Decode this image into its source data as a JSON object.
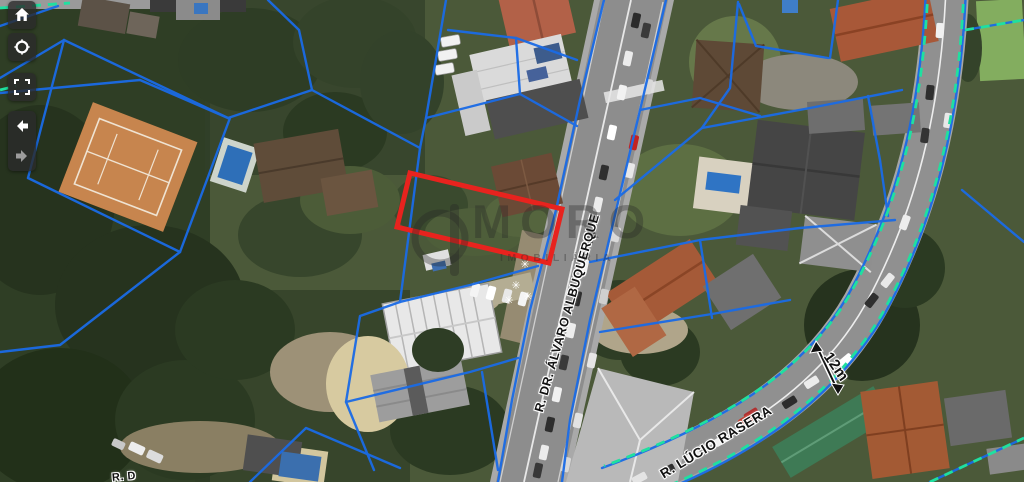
{
  "watermark": {
    "brand": "MORO",
    "tagline": "IMOBILIÁRIA"
  },
  "streets": [
    {
      "name": "R. DR. ÁLVARO ALBUQUERQUE"
    },
    {
      "name": "R. LÚCIO RASERA"
    }
  ],
  "annotations": {
    "road_width": "12m",
    "clipped_street_label": "R. D",
    "tree_symbol": "✳"
  },
  "toolbar": {
    "buttons": [
      {
        "id": "home",
        "icon": "home-icon"
      },
      {
        "id": "locate",
        "icon": "locate-icon"
      },
      {
        "id": "fullscreen",
        "icon": "fullscreen-icon"
      },
      {
        "id": "back",
        "icon": "back-arrow-icon"
      },
      {
        "id": "forward",
        "icon": "forward-arrow-icon"
      }
    ]
  },
  "colors": {
    "parcel_line": "#1a6be6",
    "road_guide_dash": "#1fe0a0",
    "selected_parcel": "#e8231e",
    "pool_water": "#3f7ec9",
    "tennis_court": "#c7854e",
    "label_text": "#121212"
  }
}
